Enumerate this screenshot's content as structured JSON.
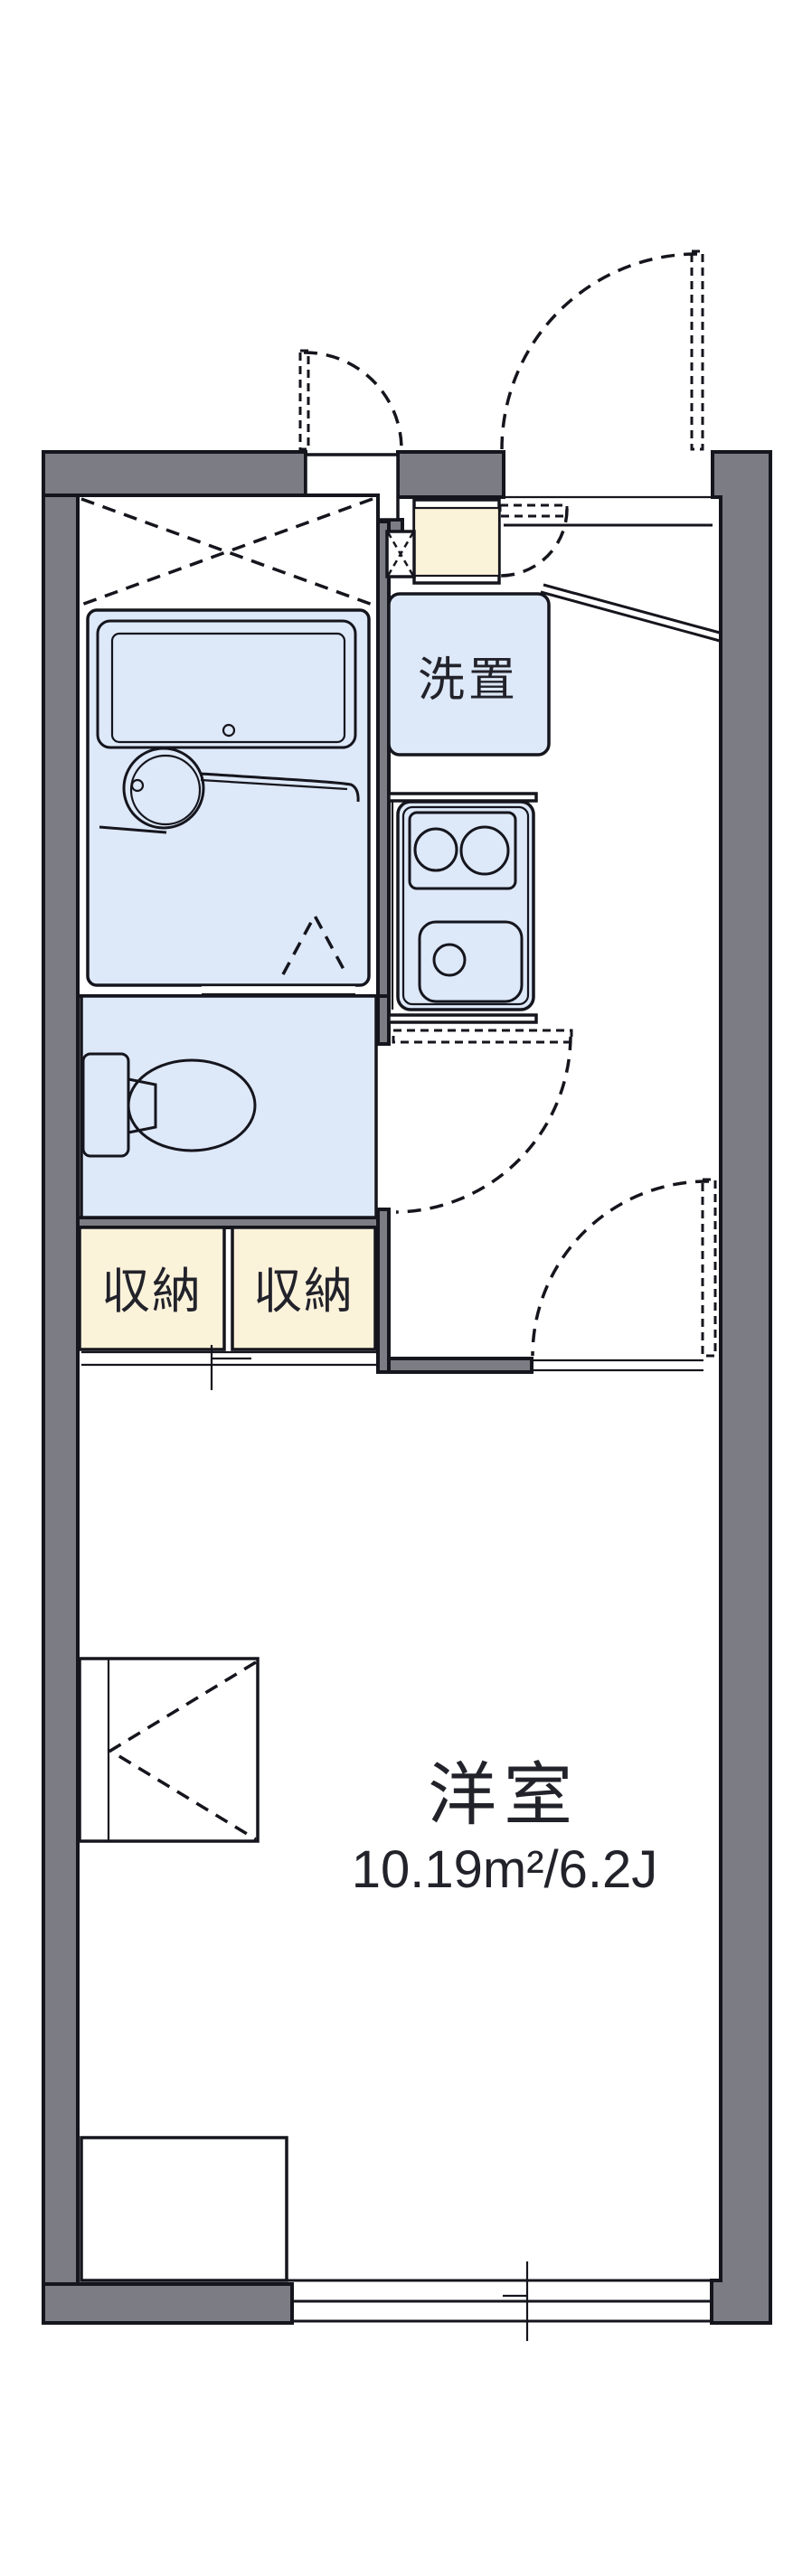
{
  "rooms": {
    "main_room": {
      "label": "洋室",
      "area": "10.19m²/6.2J"
    },
    "laundry": {
      "label": "洗置"
    },
    "storage_left": {
      "label": "収納"
    },
    "storage_right": {
      "label": "収納"
    }
  },
  "colors": {
    "wall": "#7c7c84",
    "fixture": "#dde8f8",
    "storage": "#fbf2da",
    "line": "#15151d",
    "text": "#22222a",
    "bg": "#ffffff"
  }
}
